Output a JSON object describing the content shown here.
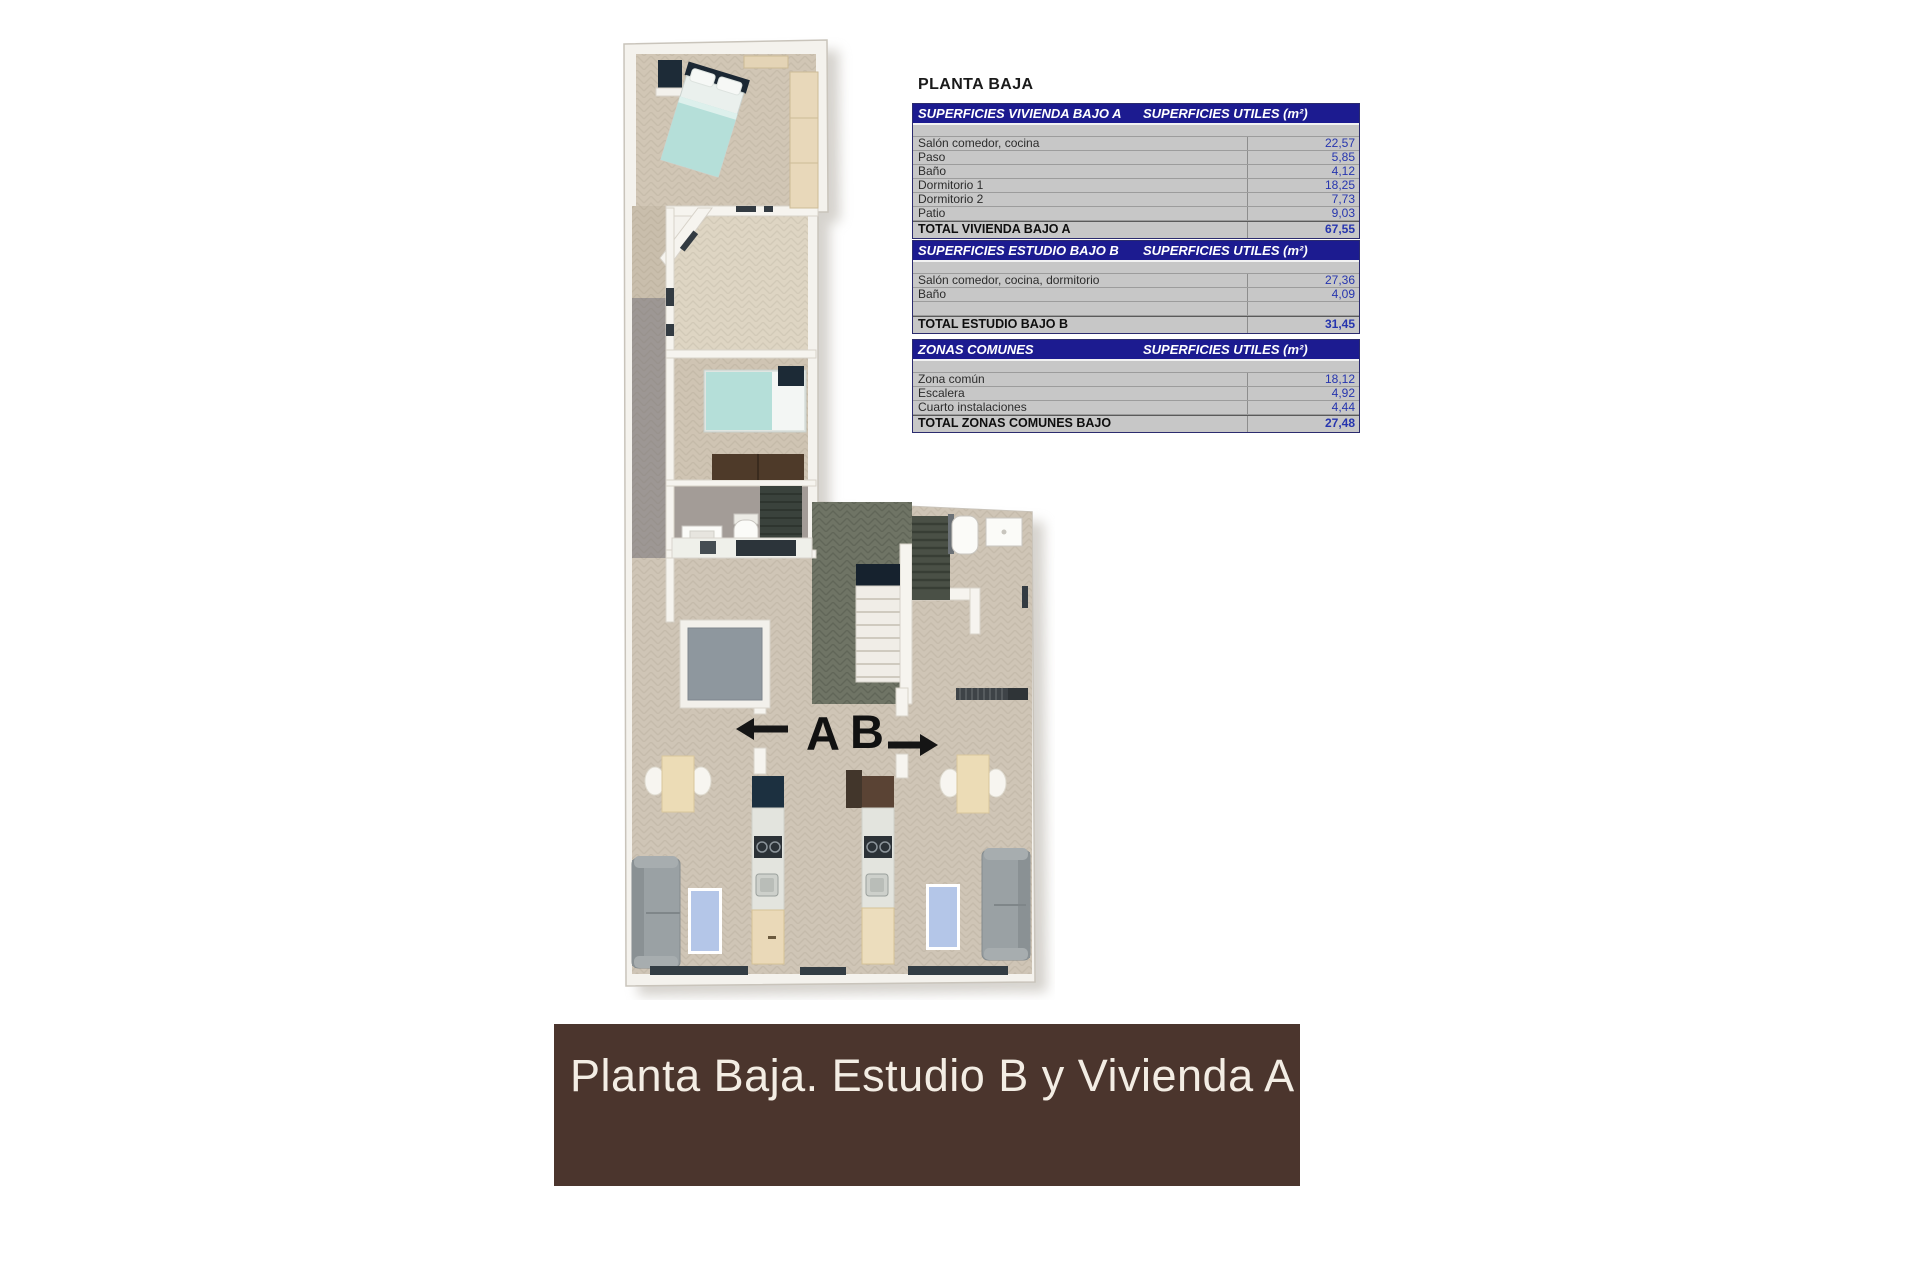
{
  "header": {
    "title": "PLANTA BAJA"
  },
  "tables": {
    "units_header": "SUPERFICIES UTILES  (m²)",
    "vivienda": {
      "title": "SUPERFICIES VIVIENDA BAJO A",
      "rows": [
        {
          "label": "Salón comedor, cocina",
          "value": "22,57"
        },
        {
          "label": "Paso",
          "value": "5,85"
        },
        {
          "label": "Baño",
          "value": "4,12"
        },
        {
          "label": "Dormitorio 1",
          "value": "18,25"
        },
        {
          "label": "Dormitorio 2",
          "value": "7,73"
        },
        {
          "label": "Patio",
          "value": "9,03"
        }
      ],
      "total_label": "TOTAL VIVIENDA BAJO A",
      "total_value": "67,55"
    },
    "estudio": {
      "title": "SUPERFICIES ESTUDIO BAJO B",
      "rows": [
        {
          "label": "Salón comedor, cocina, dormitorio",
          "value": "27,36"
        },
        {
          "label": "Baño",
          "value": "4,09"
        },
        {
          "label": "",
          "value": ""
        }
      ],
      "total_label": "TOTAL ESTUDIO BAJO B",
      "total_value": "31,45"
    },
    "comunes": {
      "title": "ZONAS COMUNES",
      "rows": [
        {
          "label": "Zona común",
          "value": "18,12"
        },
        {
          "label": "Escalera",
          "value": "4,92"
        },
        {
          "label": "Cuarto instalaciones",
          "value": "4,44"
        }
      ],
      "total_label": "TOTAL ZONAS COMUNES BAJO",
      "total_value": "27,48"
    }
  },
  "plan": {
    "unit_a_label": "A",
    "unit_b_label": "B"
  },
  "banner": {
    "caption": "Planta Baja. Estudio B y Vivienda A"
  },
  "colors": {
    "banner_bg": "#4b352d",
    "table_header_bg": "#1c1b90",
    "table_row_bg": "#c7c7c7",
    "table_value_text": "#2635ae",
    "floor_beige": "#cfc5b6",
    "patio_floor": "#ded5c3",
    "corridor_gray": "#9d9794",
    "common_zone_olive": "#6f7465",
    "bed_teal": "#b5dfd9",
    "rug_blue": "#b4c6e8",
    "sofa_gray": "#9aa1a4",
    "wardrobe_wood": "#e8d8ba",
    "dark_navy": "#1b2733"
  }
}
